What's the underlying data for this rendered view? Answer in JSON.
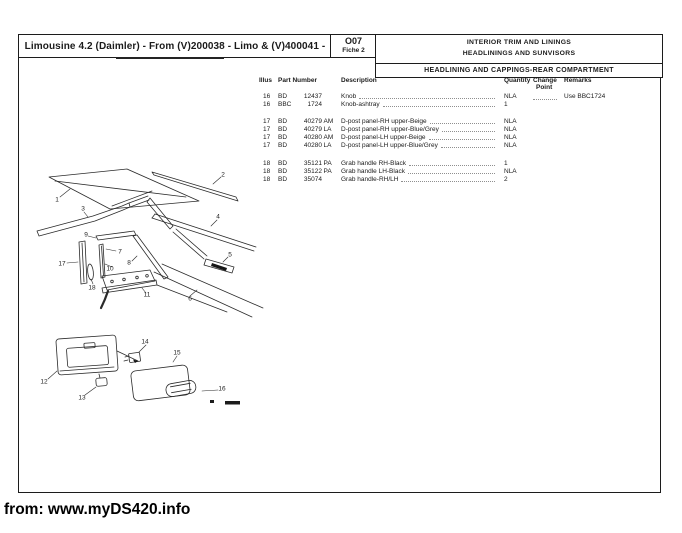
{
  "page": {
    "header": {
      "title": "Limousine 4.2 (Daimler) - From (V)200038 - Limo & (V)400041 -",
      "fiche": {
        "code": "O07",
        "line2": "Fiche 2"
      },
      "section": {
        "line1": "INTERIOR TRIM AND LININGS",
        "line2": "HEADLININGS AND SUNVISORS"
      },
      "subsection": "HEADLINING AND CAPPINGS-REAR COMPARTMENT"
    },
    "table": {
      "columns": {
        "illus": "Illus",
        "part_number": "Part Number",
        "description": "Description",
        "quantity": "Quantity",
        "change_line1": "Change",
        "change_line2": "Point",
        "remarks": "Remarks"
      },
      "rows": [
        {
          "illus": "16",
          "prefix": "BD",
          "num": "12437",
          "suffix": "",
          "desc": "Knob",
          "qty": "NLA",
          "change_dots": true,
          "remarks": "Use BBC1724"
        },
        {
          "illus": "16",
          "prefix": "BBC",
          "num": "1724",
          "suffix": "",
          "desc": "Knob-ashtray",
          "qty": "1",
          "remarks": ""
        },
        {
          "illus": "17",
          "prefix": "BD",
          "num": "40279",
          "suffix": "AM",
          "desc": "D-post panel-RH upper-Beige",
          "qty": "NLA",
          "remarks": ""
        },
        {
          "illus": "17",
          "prefix": "BD",
          "num": "40279",
          "suffix": "LA",
          "desc": "D-post panel-RH upper-Blue/Grey",
          "qty": "NLA",
          "remarks": ""
        },
        {
          "illus": "17",
          "prefix": "BD",
          "num": "40280",
          "suffix": "AM",
          "desc": "D-post panel-LH upper-Beige",
          "qty": "NLA",
          "remarks": ""
        },
        {
          "illus": "17",
          "prefix": "BD",
          "num": "40280",
          "suffix": "LA",
          "desc": "D-post panel-LH upper-Blue/Grey",
          "qty": "NLA",
          "remarks": ""
        },
        {
          "illus": "18",
          "prefix": "BD",
          "num": "35121",
          "suffix": "PA",
          "desc": "Grab handle RH-Black",
          "qty": "1",
          "remarks": ""
        },
        {
          "illus": "18",
          "prefix": "BD",
          "num": "35122",
          "suffix": "PA",
          "desc": "Grab handle LH-Black",
          "qty": "NLA",
          "remarks": ""
        },
        {
          "illus": "18",
          "prefix": "BD",
          "num": "35074",
          "suffix": "",
          "desc": "Grab handle-RH/LH",
          "qty": "2",
          "remarks": ""
        }
      ]
    },
    "diagram": {
      "callouts": [
        {
          "n": "1",
          "x": 57,
          "y": 200
        },
        {
          "n": "2",
          "x": 223,
          "y": 175
        },
        {
          "n": "3",
          "x": 83,
          "y": 209
        },
        {
          "n": "4",
          "x": 218,
          "y": 217
        },
        {
          "n": "5",
          "x": 230,
          "y": 255
        },
        {
          "n": "6",
          "x": 190,
          "y": 299
        },
        {
          "n": "7",
          "x": 120,
          "y": 252
        },
        {
          "n": "8",
          "x": 129,
          "y": 263
        },
        {
          "n": "9",
          "x": 86,
          "y": 235
        },
        {
          "n": "10",
          "x": 110,
          "y": 269
        },
        {
          "n": "11",
          "x": 147,
          "y": 295
        },
        {
          "n": "12",
          "x": 44,
          "y": 382
        },
        {
          "n": "13",
          "x": 82,
          "y": 398
        },
        {
          "n": "14",
          "x": 145,
          "y": 342
        },
        {
          "n": "15",
          "x": 177,
          "y": 353
        },
        {
          "n": "16",
          "x": 222,
          "y": 389
        },
        {
          "n": "17",
          "x": 62,
          "y": 264
        },
        {
          "n": "18",
          "x": 92,
          "y": 288
        }
      ]
    },
    "footer": "from: www.myDS420.info"
  }
}
